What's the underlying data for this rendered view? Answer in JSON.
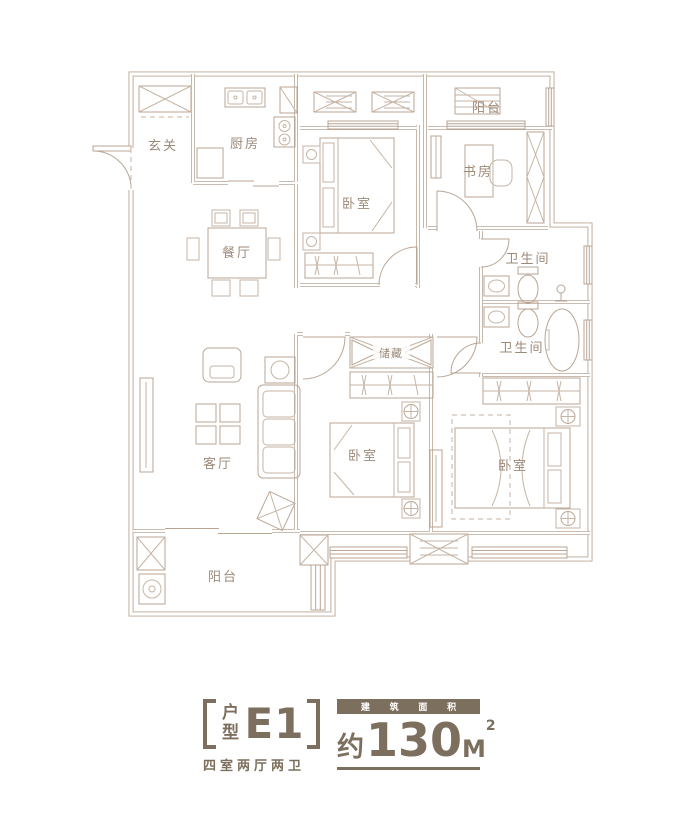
{
  "rooms": {
    "entry": {
      "label": "玄关"
    },
    "kitchen": {
      "label": "厨房"
    },
    "balcony_top": {
      "label": "阳台"
    },
    "bedroom_top": {
      "label": "卧室"
    },
    "study": {
      "label": "书房"
    },
    "bath_top": {
      "label": "卫生间"
    },
    "bath_bottom": {
      "label": "卫生间"
    },
    "dining": {
      "label": "餐厅"
    },
    "storage": {
      "label": "储藏"
    },
    "living": {
      "label": "客厅"
    },
    "bedroom_mid": {
      "label": "卧室"
    },
    "bedroom_master": {
      "label": "卧室"
    },
    "balcony_bottom": {
      "label": "阳台"
    }
  },
  "title": {
    "type_char_top": "户",
    "type_char_bottom": "型",
    "unit_code": "E1",
    "layout_summary": "四室两厅两卫",
    "area_label_chars": [
      "建",
      "筑",
      "面",
      "积"
    ],
    "area_prefix": "约",
    "area_value": "130",
    "area_unit": "M",
    "area_exponent": "2"
  },
  "colors": {
    "line": "#b9a695",
    "line-soft": "#c6b5a4",
    "label": "#9c8a79",
    "title": "#7d6f5d",
    "box-text": "#ffffff",
    "bg": "#ffffff"
  }
}
